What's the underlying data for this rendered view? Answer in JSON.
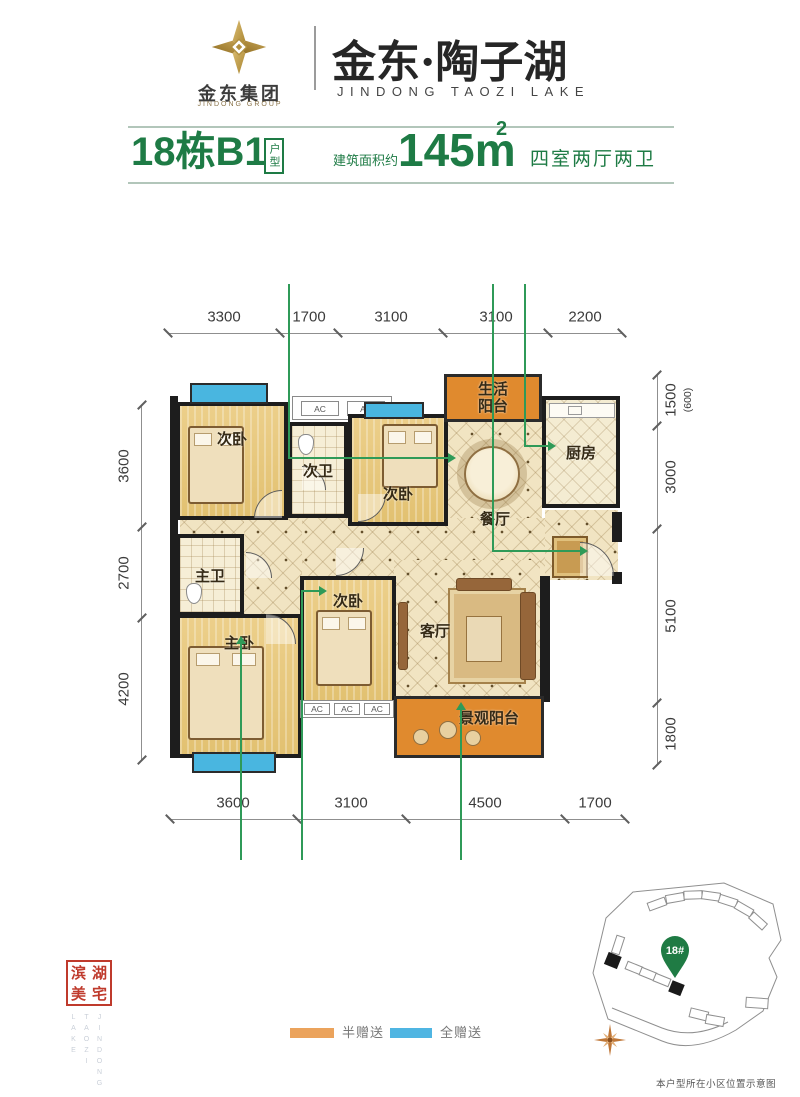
{
  "header": {
    "group_name": "金东集团",
    "group_name_en": "JINDONG GROUP",
    "project_name": "金东·陶子湖",
    "project_name_en": "JINDONG TAOZI LAKE"
  },
  "title_bar": {
    "unit_title": "18栋B1",
    "unit_tag": "户型",
    "area_prefix": "建筑面积约",
    "area_value": "145m",
    "area_sup": "2",
    "room_config": "四室两厅两卫"
  },
  "floor_plan": {
    "dims_top": [
      "3300",
      "1700",
      "3100",
      "3100",
      "2200"
    ],
    "dims_left": [
      "3600",
      "2700",
      "4200"
    ],
    "dims_right_main": [
      "1500",
      "3000",
      "5100",
      "1800"
    ],
    "dims_right_sub": "(600)",
    "dims_bottom": [
      "3600",
      "3100",
      "4500",
      "1700"
    ],
    "ac_label": "AC",
    "rooms": {
      "bedroom_top_left": "次卧",
      "bath_secondary": "次卫",
      "bedroom_top_mid": "次卧",
      "balcony_life": "生活阳台",
      "kitchen": "厨房",
      "dining": "餐厅",
      "bath_master": "主卫",
      "bedroom_master": "主卧",
      "bedroom_mid": "次卧",
      "living": "客厅",
      "balcony_view": "景观阳台"
    }
  },
  "legend": {
    "half_gift": {
      "label": "半赠送",
      "color": "#EBA35C"
    },
    "full_gift": {
      "label": "全赠送",
      "color": "#4FB5E2"
    }
  },
  "seal": {
    "chars": [
      "滨",
      "湖",
      "美",
      "宅"
    ],
    "en_lines": [
      "JINDONG",
      "TAOZI",
      "LAKE"
    ]
  },
  "site_map": {
    "pin_label": "18#",
    "caption": "本户型所在小区位置示意图"
  },
  "colors": {
    "brand_green": "#1E7B45",
    "wall_black": "#1D1D1D",
    "balcony_orange": "#E08A2E",
    "balcony_blue": "#49B6E0",
    "seal_red": "#BF3A2C",
    "leader_green": "#2F9A58"
  }
}
